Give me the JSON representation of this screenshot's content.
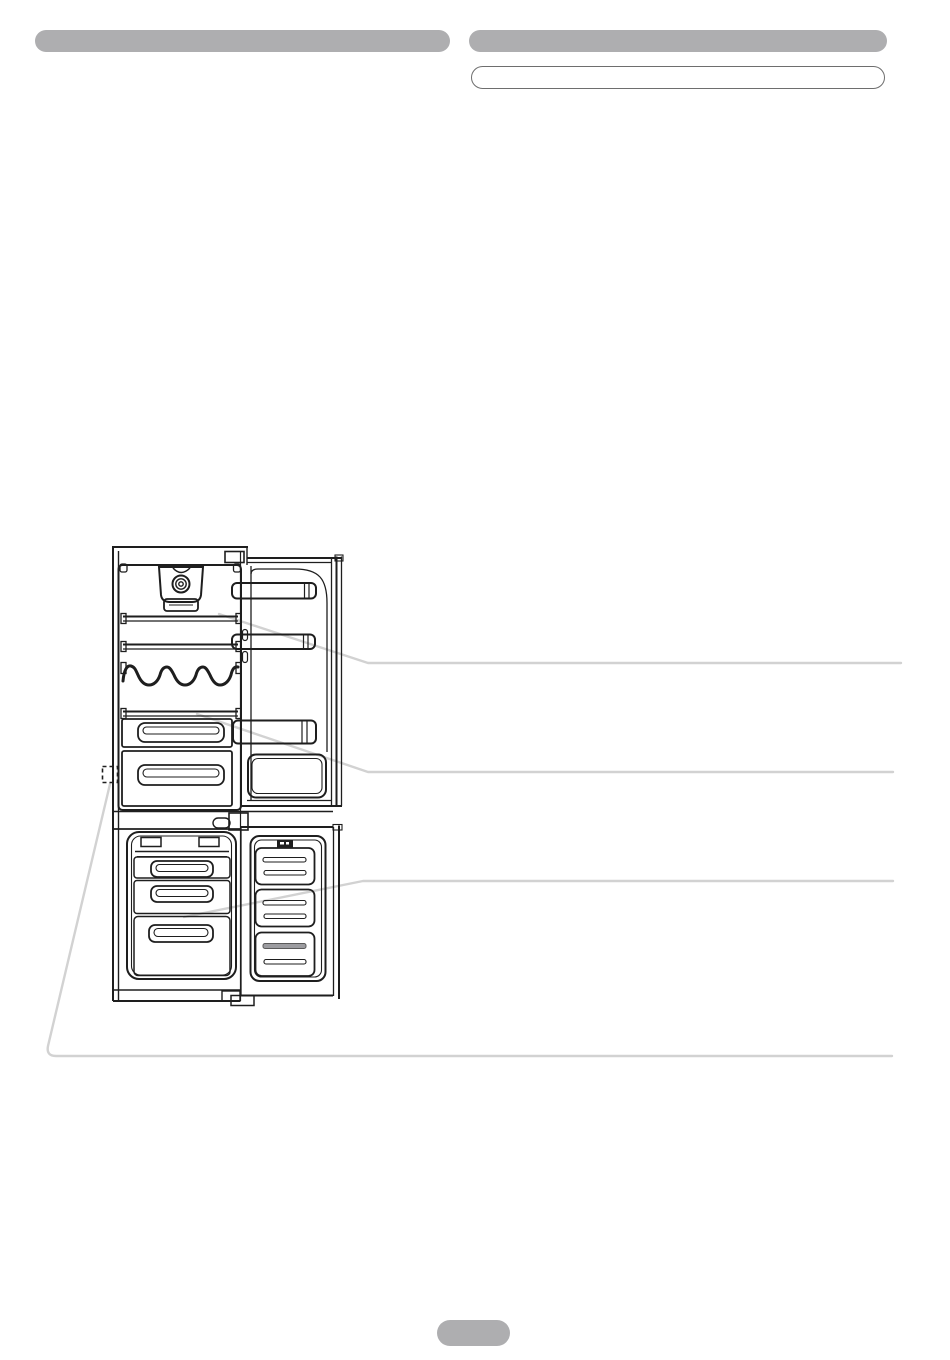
{
  "header": {
    "left_title": "",
    "right_title": "",
    "right_subtitle": ""
  },
  "figure": {
    "kind": "line-drawing",
    "subject": "fridge-freezer-product-overview",
    "callout_count": 4,
    "callouts": [
      {
        "name": "refrigerator-shelf-callout"
      },
      {
        "name": "crisper-cover-callout"
      },
      {
        "name": "freezer-drawer-callout"
      },
      {
        "name": "rating-plate-callout"
      }
    ]
  },
  "footer": {
    "page_number": ""
  },
  "colors": {
    "background": "#ffffff",
    "redacted_bar_gray": "#aeaeb0",
    "subtitle_border": "#6e6e6e",
    "drawing_line": "#1e1e1e",
    "callout_line_gray": "#d2d2d2"
  }
}
